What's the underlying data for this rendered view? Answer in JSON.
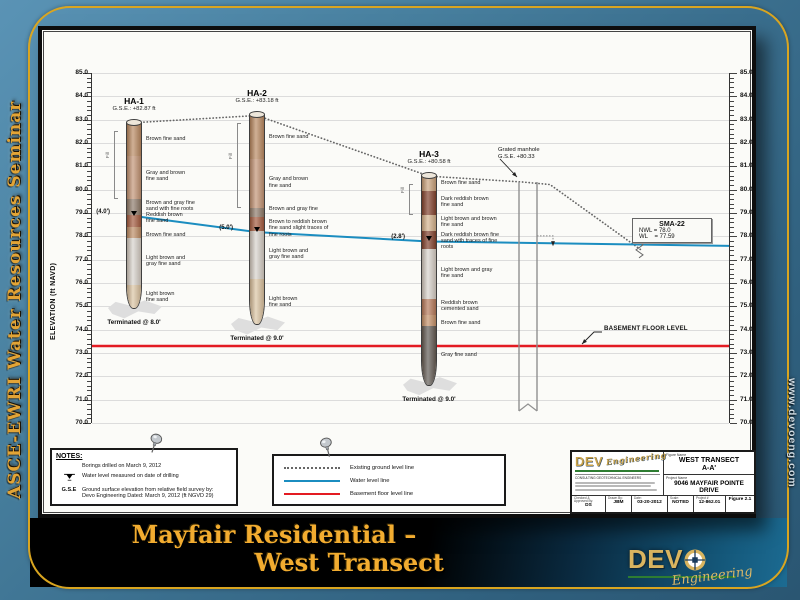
{
  "sidebar_left": {
    "text": "ASCE-EWRI Water Resources Seminar"
  },
  "sidebar_right": {
    "text": "www.devoeng.com"
  },
  "slide_title": {
    "line1": "Mayfair Residential –",
    "line2": "West Transect"
  },
  "colors": {
    "water": "#1b8dc0",
    "basement": "#e31b22",
    "ground": "#666666",
    "gold": "#d9a520"
  },
  "chart_data": {
    "type": "cross-section",
    "ylabel": "ELEVATION (ft NAVD)",
    "ylim": [
      70,
      85
    ],
    "tick_step": 1.0,
    "grid": true,
    "borings": [
      {
        "id": "HA-1",
        "x": 42,
        "gse_label": "G.S.E.: +82.87 ft",
        "gse": 82.87,
        "bottom": 74.87,
        "water_elev": 78.87,
        "water_label": "(4.0')",
        "terminated_label": "Terminated @ 8.0'",
        "fill_label": "Fill",
        "fill_bottom": 79.65,
        "layers": [
          {
            "label": "Brown fine sand",
            "from": 82.87,
            "to": 81.5,
            "color": "#b98a63"
          },
          {
            "label": "Gray and brown\nfine sand",
            "from": 81.5,
            "to": 79.65,
            "color": "#c29476"
          },
          {
            "label": "Brown and gray fine\nsand with fine roots",
            "from": 79.65,
            "to": 78.95,
            "color": "#8d7b6c"
          },
          {
            "label": "Reddish brown\nfine sand",
            "from": 78.95,
            "to": 78.45,
            "color": "#a2593e",
            "dy": -2
          },
          {
            "label": "Brown fine sand",
            "from": 78.45,
            "to": 77.95,
            "color": "#bd8d66",
            "dy": 3
          },
          {
            "label": "Light brown and\ngray fine sand",
            "from": 77.95,
            "to": 75.95,
            "color": "#d7d3cd"
          },
          {
            "label": "Light brown\nfine sand",
            "from": 75.95,
            "to": 74.87,
            "color": "#dbc5a4"
          }
        ]
      },
      {
        "id": "HA-2",
        "x": 165,
        "gse_label": "G.S.E.: +83.18 ft",
        "gse": 83.18,
        "bottom": 74.18,
        "water_elev": 78.18,
        "water_label": "(5.0')",
        "terminated_label": "Terminated @ 9.0'",
        "fill_label": "Fill",
        "fill_bottom": 79.25,
        "layers": [
          {
            "label": "Brown fine sand",
            "from": 83.18,
            "to": 81.35,
            "color": "#b98a63"
          },
          {
            "label": "Gray and brown\nfine sand",
            "from": 81.35,
            "to": 79.25,
            "color": "#c29476"
          },
          {
            "label": "Brown and gray fine",
            "from": 79.25,
            "to": 78.85,
            "color": "#8d7b6c",
            "dy": -3
          },
          {
            "label": "Brown to reddish brown\nfine sand slight traces of\nfine roots",
            "from": 78.85,
            "to": 78.25,
            "color": "#a2593e",
            "dy": 5
          },
          {
            "label": "Light brown and\ngray fine sand",
            "from": 78.25,
            "to": 76.2,
            "color": "#d7d3cd"
          },
          {
            "label": "Light brown\nfine sand",
            "from": 76.2,
            "to": 74.18,
            "color": "#dbc5a4"
          }
        ]
      },
      {
        "id": "HA-3",
        "x": 337,
        "gse_label": "G.S.E.: +80.58 ft",
        "gse": 80.58,
        "bottom": 71.58,
        "water_elev": 77.78,
        "water_label": "(2.8')",
        "terminated_label": "Terminated @ 9.0'",
        "fill_label": "Fill",
        "fill_bottom": 78.95,
        "label_w": 72,
        "layers": [
          {
            "label": "Brown fine sand",
            "from": 80.58,
            "to": 80.0,
            "color": "#c9a37e"
          },
          {
            "label": "Dark reddish brown\nfine sand",
            "from": 80.0,
            "to": 78.95,
            "color": "#7f3f2c"
          },
          {
            "label": "Light brown and brown\nfine sand",
            "from": 78.95,
            "to": 78.25,
            "color": "#d4b38e"
          },
          {
            "label": "Dark reddish brown fine\nsand with traces of fine\nroots",
            "from": 78.25,
            "to": 77.5,
            "color": "#7f3f2c",
            "dy": 2
          },
          {
            "label": "Light brown and gray\nfine sand",
            "from": 77.5,
            "to": 75.35,
            "color": "#d7d3cd"
          },
          {
            "label": "Reddish brown\ncemented sand",
            "from": 75.35,
            "to": 74.65,
            "color": "#b5795b"
          },
          {
            "label": "Brown fine sand",
            "from": 74.65,
            "to": 74.2,
            "color": "#c4916a",
            "dy": 3
          },
          {
            "label": "Gray fine sand",
            "from": 74.2,
            "to": 71.58,
            "color": "#5e5954"
          }
        ]
      }
    ],
    "lines": {
      "ground": {
        "label": "Existing ground level line",
        "color": "#666666",
        "points": [
          [
            42,
            82.87
          ],
          [
            165,
            83.18
          ],
          [
            337,
            80.58
          ],
          [
            430,
            80.33
          ],
          [
            458,
            80.22
          ],
          [
            549,
            77.42
          ]
        ]
      },
      "water": {
        "label": "Water level line",
        "color": "#1b8dc0",
        "points": [
          [
            42,
            78.87
          ],
          [
            165,
            78.18
          ],
          [
            337,
            77.78
          ],
          [
            637,
            77.59
          ]
        ]
      },
      "basement": {
        "label": "Basement floor level line",
        "color": "#e31b22",
        "elev": 73.3
      }
    },
    "structures": {
      "manhole": {
        "x1": 427,
        "x2": 445,
        "top_elev": 80.33,
        "bottom_y": 338
      },
      "manhole_step": {
        "pts": [
          [
            445,
            78.02
          ],
          [
            461,
            78.02
          ],
          [
            461,
            77.66
          ]
        ]
      }
    },
    "annotations": {
      "manhole": {
        "line1": "Grated manhole",
        "line2": "G.S.E. +80.33"
      },
      "sma": {
        "title": "SMA-22",
        "nwl": "NWL = 78.0",
        "wl": "WL    = 77.59"
      },
      "basement_label": "BASEMENT FLOOR LEVEL",
      "leaders": [
        {
          "points": [
            [
              408,
              86
            ],
            [
              425,
              104
            ]
          ]
        },
        {
          "points": [
            [
              510,
              259
            ],
            [
              502,
              259
            ],
            [
              490,
              271
            ]
          ]
        }
      ]
    }
  },
  "notes": {
    "title": "NOTES:",
    "rows": [
      {
        "term": "",
        "text": "Borings drilled on March 9, 2012"
      },
      {
        "term": "water-level-symbol",
        "text": "Water level measured on date of drilling"
      },
      {
        "term": "G.S.E",
        "text": "Ground surface elevation from relative field survey by:\nDevo Engineering Dated: March 9, 2012 (ft NGVD 29)"
      }
    ]
  },
  "legend": {
    "items": [
      {
        "name": "existing-ground",
        "label": "Existing ground level line"
      },
      {
        "name": "water-level",
        "label": "Water level line"
      },
      {
        "name": "basement-floor",
        "label": "Basement floor level line"
      }
    ]
  },
  "title_block": {
    "logo_text": "DEV",
    "logo_script": "Engineering",
    "logo_sub": "CONSULTING GEOTECHNICAL ENGINEERS",
    "figure_name_label": "Figure Name",
    "figure_name_1": "WEST TRANSECT",
    "figure_name_2": "A-A'",
    "project_name_label": "Project Name",
    "project_name_1": "9046 MAYFAIR POINTE",
    "project_name_2": "DRIVE",
    "fields": [
      {
        "label": "Checked & Approved By:",
        "value": "DS"
      },
      {
        "label": "Drawn By:",
        "value": "JBM"
      },
      {
        "label": "Date:",
        "value": "03-20-2012"
      },
      {
        "label": "Scale:",
        "value": "NOTED"
      },
      {
        "label": "Project #",
        "value": "12-862.01"
      },
      {
        "label": "",
        "value": "Figure 2.1"
      }
    ]
  },
  "footer_logo": {
    "text": "DEV",
    "script": "Engineering"
  }
}
